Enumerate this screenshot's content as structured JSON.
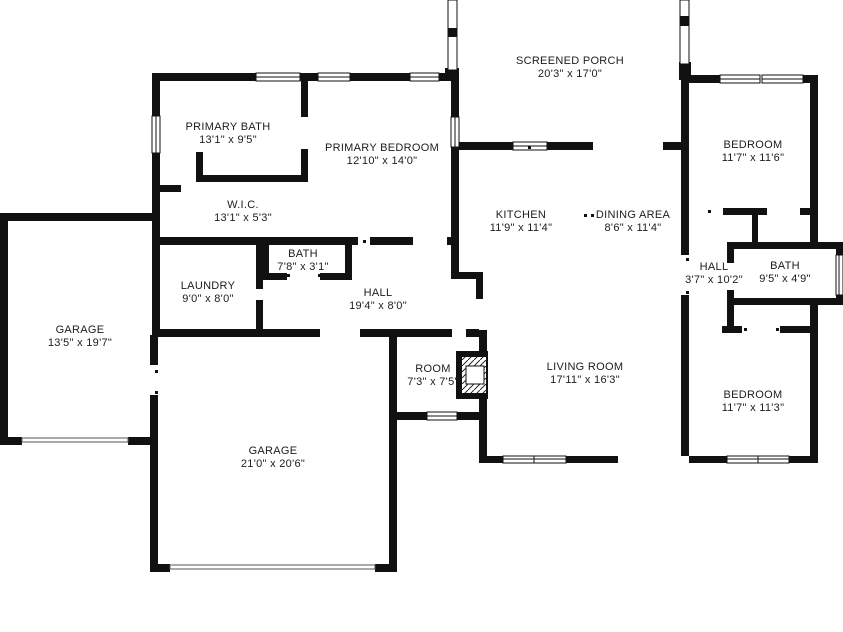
{
  "plan": {
    "type": "floor-plan",
    "colors": {
      "wall": "#111111",
      "background": "#ffffff",
      "text": "#1c1c1c"
    },
    "features": [
      "fireplace",
      "screened-porch",
      "garage-doors",
      "windows"
    ]
  },
  "rooms": [
    {
      "name": "PRIMARY BATH",
      "dims": "13'1\" x 9'5\""
    },
    {
      "name": "PRIMARY BEDROOM",
      "dims": "12'10\" x 14'0\""
    },
    {
      "name": "SCREENED PORCH",
      "dims": "20'3\" x 17'0\""
    },
    {
      "name": "BEDROOM",
      "dims": "11'7\" x 11'6\""
    },
    {
      "name": "W.I.C.",
      "dims": "13'1\" x 5'3\""
    },
    {
      "name": "KITCHEN",
      "dims": "11'9\" x 11'4\""
    },
    {
      "name": "DINING AREA",
      "dims": "8'6\" x 11'4\""
    },
    {
      "name": "HALL",
      "dims": "3'7\" x 10'2\""
    },
    {
      "name": "BATH",
      "dims": "9'5\" x 4'9\""
    },
    {
      "name": "BATH",
      "dims": "7'8\" x 3'1\""
    },
    {
      "name": "LAUNDRY",
      "dims": "9'0\" x 8'0\""
    },
    {
      "name": "HALL",
      "dims": "19'4\" x 8'0\""
    },
    {
      "name": "GARAGE",
      "dims": "13'5\" x 19'7\""
    },
    {
      "name": "ROOM",
      "dims": "7'3\" x 7'5\""
    },
    {
      "name": "LIVING ROOM",
      "dims": "17'11\" x 16'3\""
    },
    {
      "name": "BEDROOM",
      "dims": "11'7\" x 11'3\""
    },
    {
      "name": "GARAGE",
      "dims": "21'0\" x 20'6\""
    }
  ]
}
